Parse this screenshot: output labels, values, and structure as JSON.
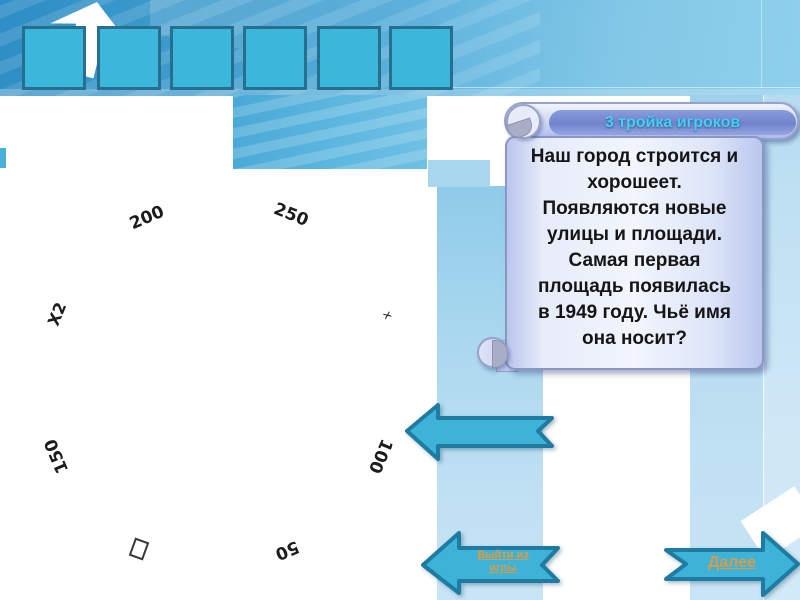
{
  "title_card": {
    "header": "3 тройка игроков",
    "question": "Наш город строится и\nхорошеет.\nПоявляются новые\nулицы и площади.\nСамая первая\nплощадь появилась\nв 1949 году. Чьё имя\nона носит?"
  },
  "wheel": {
    "labels": [
      {
        "text": "200"
      },
      {
        "text": "250"
      },
      {
        "text": "X2"
      },
      {
        "text": "x"
      },
      {
        "text": "150"
      },
      {
        "text": "100"
      },
      {
        "text": "50"
      }
    ]
  },
  "nav": {
    "exit_label": "Выйти из\nигры",
    "next_label": "Далее"
  },
  "colors": {
    "square_fill": "#3db6db",
    "square_border": "#276f8e",
    "arrow_fill": "#3eb3d8",
    "arrow_border": "#1f7ba2",
    "nav_link_text": "#db9b45",
    "card_header_text": "#3fd2f2",
    "card_header_fill": "#7084cd",
    "card_body_fill": "#e7ecfa",
    "top_band_fill": "#55abd8",
    "stripe_fill": "#b5dcf1"
  }
}
